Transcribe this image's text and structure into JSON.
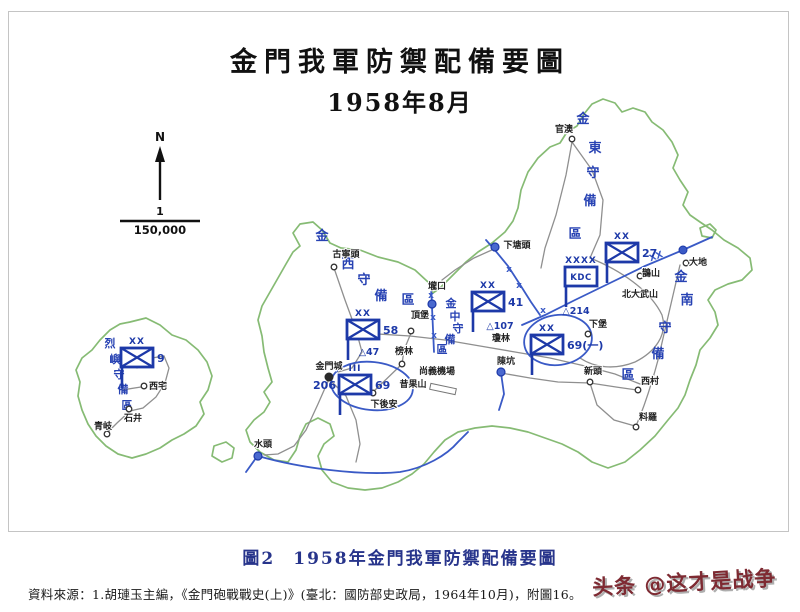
{
  "header": {
    "title_line1": "金門我軍防禦配備要圖",
    "title_line2": "1958年8月"
  },
  "compass": {
    "label": "N",
    "scale_numerator": "1",
    "scale_denominator": "150,000"
  },
  "caption": {
    "figure_label": "圖2",
    "figure_title": "1958年金門我軍防禦配備要圖"
  },
  "source_line": "資料來源：1.胡璉玉主編，《金門砲戰戰史(上)》(臺北：國防部史政局，1964年10月)，附圖16。",
  "watermark": {
    "text": "头条 @这才是战争"
  },
  "colors": {
    "unit_blue": "#1d39a8",
    "zone_blue": "#2742b3",
    "line_blue": "#3a5ac6",
    "coast_green": "#86bb74",
    "road_gray": "#8f8f8f",
    "caption_navy": "#27348b",
    "watermark_red": "#7e2a32"
  },
  "map": {
    "zones": [
      {
        "name": "金東守備區",
        "size": 13,
        "chars": [
          {
            "c": "金",
            "x": 583,
            "y": 123
          },
          {
            "c": "東",
            "x": 595,
            "y": 152
          },
          {
            "c": "守",
            "x": 593,
            "y": 177
          },
          {
            "c": "備",
            "x": 590,
            "y": 205
          },
          {
            "c": "區",
            "x": 575,
            "y": 238
          }
        ]
      },
      {
        "name": "金西守備區",
        "size": 13,
        "chars": [
          {
            "c": "金",
            "x": 322,
            "y": 240
          },
          {
            "c": "西",
            "x": 348,
            "y": 268
          },
          {
            "c": "守",
            "x": 364,
            "y": 284
          },
          {
            "c": "備",
            "x": 381,
            "y": 300
          },
          {
            "c": "區",
            "x": 408,
            "y": 304
          }
        ]
      },
      {
        "name": "金中守備區",
        "size": 11,
        "chars": [
          {
            "c": "金",
            "x": 451,
            "y": 307
          },
          {
            "c": "中",
            "x": 455,
            "y": 320
          },
          {
            "c": "守",
            "x": 458,
            "y": 332
          },
          {
            "c": "備",
            "x": 450,
            "y": 343
          },
          {
            "c": "區",
            "x": 442,
            "y": 353
          }
        ]
      },
      {
        "name": "金南守備區",
        "size": 13,
        "chars": [
          {
            "c": "金",
            "x": 681,
            "y": 281
          },
          {
            "c": "南",
            "x": 687,
            "y": 304
          },
          {
            "c": "守",
            "x": 665,
            "y": 332
          },
          {
            "c": "備",
            "x": 658,
            "y": 358
          },
          {
            "c": "區",
            "x": 628,
            "y": 379
          }
        ]
      },
      {
        "name": "烈嶼守備區",
        "size": 11,
        "chars": [
          {
            "c": "烈",
            "x": 110,
            "y": 347
          },
          {
            "c": "嶼",
            "x": 115,
            "y": 363
          },
          {
            "c": "守",
            "x": 119,
            "y": 378
          },
          {
            "c": "備",
            "x": 123,
            "y": 393
          },
          {
            "c": "區",
            "x": 127,
            "y": 409
          }
        ]
      }
    ],
    "units": [
      {
        "name": "unit-kdc",
        "type": "hq",
        "hq_text": "KDC",
        "echelon": "XXXX",
        "x": 581,
        "y": 277,
        "label_right": ""
      },
      {
        "name": "unit-27-division",
        "type": "infantry",
        "echelon": "XX",
        "x": 622,
        "y": 253,
        "label_right": "27"
      },
      {
        "name": "unit-41-division",
        "type": "infantry",
        "echelon": "XX",
        "x": 488,
        "y": 302,
        "label_right": "41"
      },
      {
        "name": "unit-58-division",
        "type": "infantry",
        "echelon": "XX",
        "x": 363,
        "y": 330,
        "label_right": "58"
      },
      {
        "name": "unit-69-1-division",
        "type": "infantry",
        "echelon": "XX",
        "x": 547,
        "y": 345,
        "label_right": "69(一)"
      },
      {
        "name": "unit-69-regiment",
        "type": "infantry",
        "echelon": "III",
        "x": 355,
        "y": 385,
        "label_left": "206",
        "label_right": "69"
      },
      {
        "name": "unit-9-division",
        "type": "infantry",
        "echelon": "XX",
        "x": 137,
        "y": 358,
        "label_right": "9"
      }
    ],
    "elevations": [
      {
        "label": "△47",
        "x": 369,
        "y": 352
      },
      {
        "label": "△107",
        "x": 500,
        "y": 326
      },
      {
        "label": "△214",
        "x": 576,
        "y": 311
      }
    ],
    "places": [
      {
        "name": "官澳",
        "x": 564,
        "y": 129,
        "marker": {
          "t": "open",
          "x": 572,
          "y": 139
        }
      },
      {
        "name": "下塘頭",
        "x": 517,
        "y": 245,
        "marker": {
          "t": "blue",
          "x": 495,
          "y": 247
        }
      },
      {
        "name": "古寧頭",
        "x": 346,
        "y": 254,
        "marker": {
          "t": "open",
          "x": 334,
          "y": 267
        }
      },
      {
        "name": "壠口",
        "x": 437,
        "y": 286,
        "marker": {
          "t": "blue",
          "x": 432,
          "y": 304
        }
      },
      {
        "name": "頂堡",
        "x": 420,
        "y": 315,
        "marker": {
          "t": "open",
          "x": 411,
          "y": 331
        }
      },
      {
        "name": "榜林",
        "x": 404,
        "y": 351,
        "marker": {
          "t": "open",
          "x": 402,
          "y": 364
        }
      },
      {
        "name": "瓊林",
        "x": 501,
        "y": 338
      },
      {
        "name": "陳坑",
        "x": 506,
        "y": 361,
        "marker": {
          "t": "blue",
          "x": 501,
          "y": 372
        }
      },
      {
        "name": "尚義機場",
        "x": 437,
        "y": 371
      },
      {
        "name": "昔果山",
        "x": 413,
        "y": 384
      },
      {
        "name": "下後安",
        "x": 384,
        "y": 404,
        "marker": {
          "t": "open",
          "x": 373,
          "y": 393
        }
      },
      {
        "name": "金門城",
        "x": 329,
        "y": 366,
        "marker": {
          "t": "filled",
          "x": 329,
          "y": 377
        }
      },
      {
        "name": "水頭",
        "x": 263,
        "y": 444,
        "marker": {
          "t": "blue",
          "x": 258,
          "y": 456
        }
      },
      {
        "name": "新頭",
        "x": 593,
        "y": 371,
        "marker": {
          "t": "open",
          "x": 590,
          "y": 382
        }
      },
      {
        "name": "西村",
        "x": 650,
        "y": 381,
        "marker": {
          "t": "open",
          "x": 638,
          "y": 390
        }
      },
      {
        "name": "料羅",
        "x": 648,
        "y": 417,
        "marker": {
          "t": "open",
          "x": 636,
          "y": 427
        }
      },
      {
        "name": "下堡",
        "x": 598,
        "y": 324,
        "marker": {
          "t": "open",
          "x": 588,
          "y": 334
        }
      },
      {
        "name": "鵲山",
        "x": 651,
        "y": 273,
        "marker": {
          "t": "open",
          "x": 640,
          "y": 276
        }
      },
      {
        "name": "北大武山",
        "x": 640,
        "y": 294
      },
      {
        "name": "大地",
        "x": 698,
        "y": 262,
        "marker": {
          "t": "open",
          "x": 686,
          "y": 263
        }
      },
      {
        "name": "西宅",
        "x": 158,
        "y": 386,
        "marker": {
          "t": "open",
          "x": 144,
          "y": 386
        }
      },
      {
        "name": "石井",
        "x": 133,
        "y": 418,
        "marker": {
          "t": "open",
          "x": 129,
          "y": 409
        }
      },
      {
        "name": "青岐",
        "x": 103,
        "y": 426,
        "marker": {
          "t": "open",
          "x": 107,
          "y": 434
        }
      }
    ],
    "boundary_marks": [
      {
        "t": "XX",
        "x": 657,
        "y": 259,
        "r": -20
      },
      {
        "t": "x",
        "x": 431,
        "y": 298
      },
      {
        "t": "x",
        "x": 433,
        "y": 320
      },
      {
        "t": "x",
        "x": 434,
        "y": 338
      },
      {
        "t": "x",
        "x": 509,
        "y": 272
      },
      {
        "t": "x",
        "x": 519,
        "y": 288
      },
      {
        "t": "x",
        "x": 543,
        "y": 313
      },
      {
        "t": "dot",
        "x": 683,
        "y": 250
      }
    ]
  }
}
